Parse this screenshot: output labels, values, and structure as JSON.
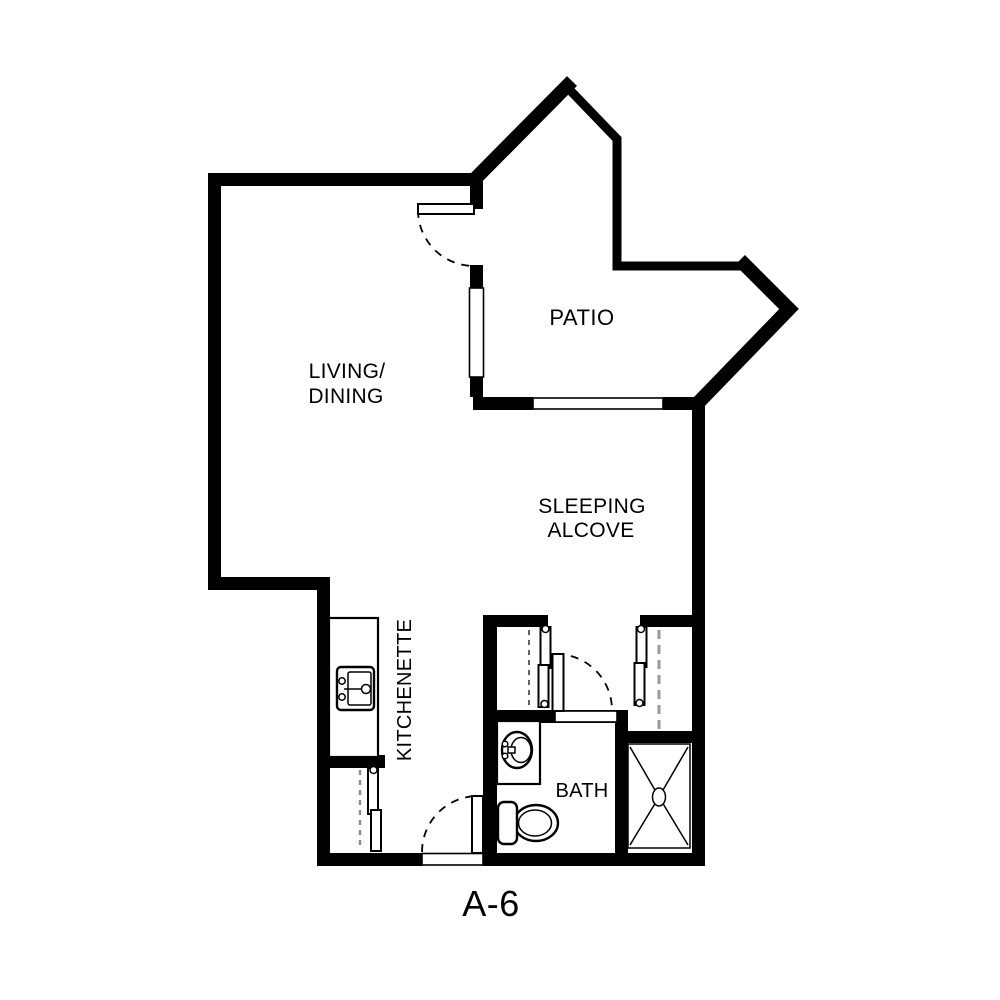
{
  "title": "A-6",
  "rooms": [
    {
      "id": "living-dining",
      "label": [
        "LIVING/",
        "DINING"
      ]
    },
    {
      "id": "patio",
      "label": [
        "PATIO"
      ]
    },
    {
      "id": "sleeping-alcove",
      "label": [
        "SLEEPING",
        "ALCOVE"
      ]
    },
    {
      "id": "kitchenette",
      "label": [
        "KITCHENETTE"
      ]
    },
    {
      "id": "bath",
      "label": [
        "BATH"
      ]
    }
  ],
  "fixtures": [
    "kitchen-counter",
    "kitchen-sink",
    "kitchenette-closet",
    "vanity-counter",
    "bathroom-sink",
    "toilet",
    "shower",
    "closet-left",
    "closet-right",
    "entry-door",
    "bath-door",
    "patio-door",
    "window-patio-side",
    "window-patio-bottom"
  ],
  "colors": {
    "walls": "#000000",
    "floor": "#ffffff",
    "closet_dash": "#9a9a9a",
    "text": "#000000"
  }
}
